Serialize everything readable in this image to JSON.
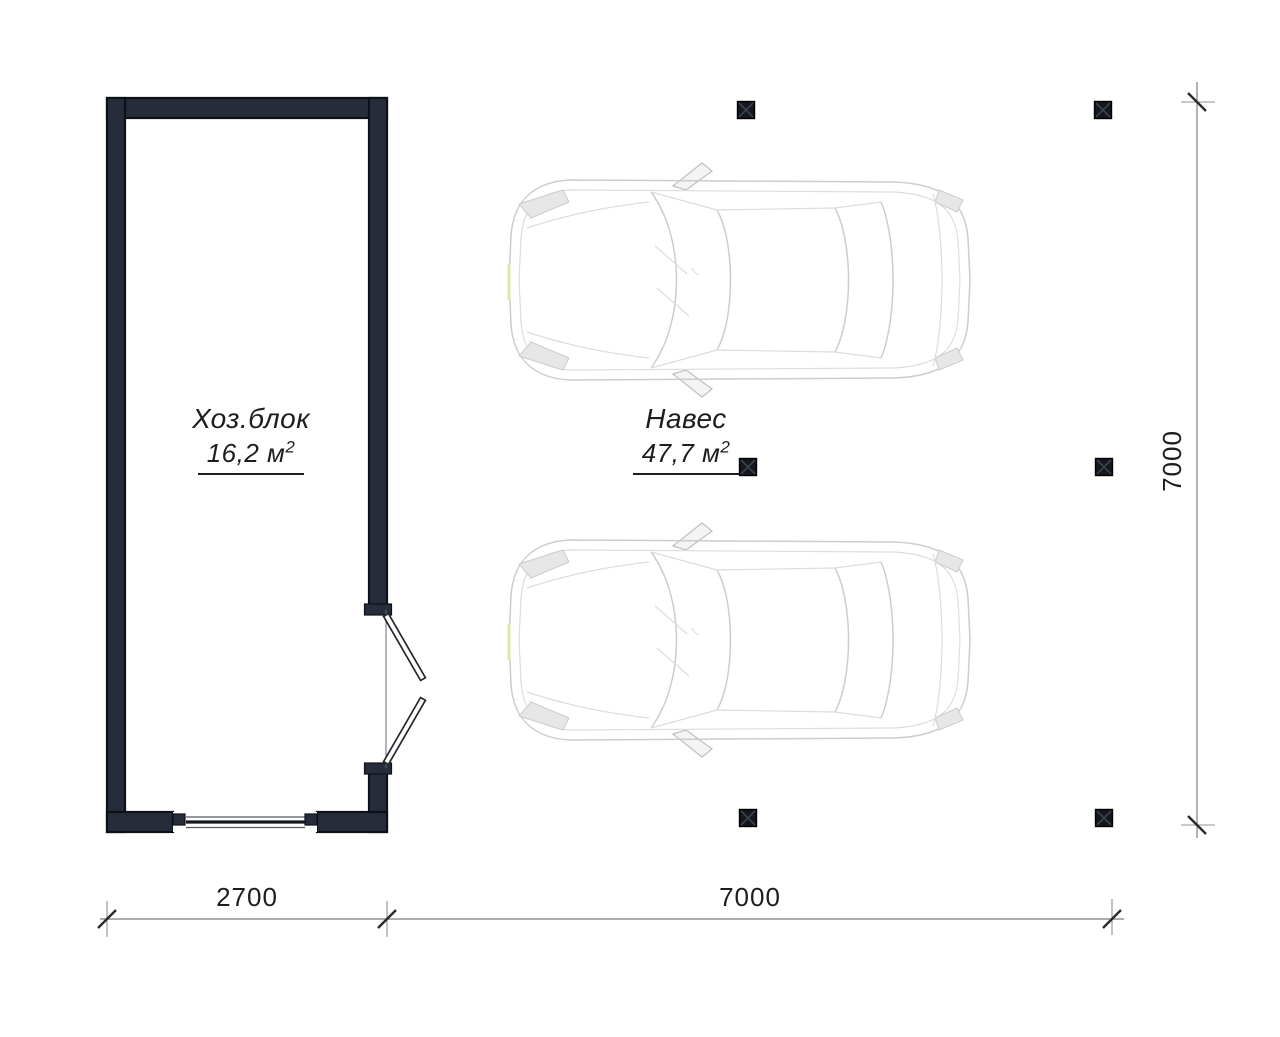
{
  "plan": {
    "utility_block": {
      "label": "Хоз.блок",
      "area_value": "16,2 м",
      "area_sup": "2"
    },
    "carport": {
      "label": "Навес",
      "area_value": "47,7 м",
      "area_sup": "2"
    },
    "dimensions": {
      "utility_width": "2700",
      "carport_width": "7000",
      "total_depth": "7000"
    }
  },
  "colors": {
    "wall": "#262c39",
    "wall_outline": "#0d1016",
    "post": "#14171e",
    "dim": "#8f9193",
    "tick": "#2b2b2b",
    "car_line": "#cdcdcd",
    "accent": "#dfe8a6",
    "text": "#1d1d1d"
  }
}
